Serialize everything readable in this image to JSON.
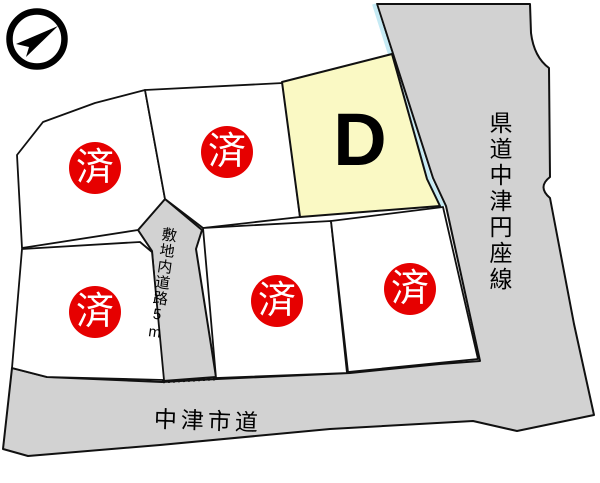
{
  "map": {
    "compass": "north-arrow",
    "featured_lot": {
      "label": "D"
    },
    "sold_lots": [
      {
        "mark": "済"
      },
      {
        "mark": "済"
      },
      {
        "mark": "済"
      },
      {
        "mark": "済"
      },
      {
        "mark": "済"
      }
    ],
    "roads": {
      "prefectural": "県道中津円座線",
      "internal": "敷地内道路5m",
      "city": "中津市道"
    },
    "colors": {
      "road": "#D2D2D2",
      "lot": "#FFFFFF",
      "featured_lot": "#FAF9C4",
      "sold_badge": "#E60000",
      "waterway": "#C5EAF4",
      "line": "#111111"
    }
  }
}
